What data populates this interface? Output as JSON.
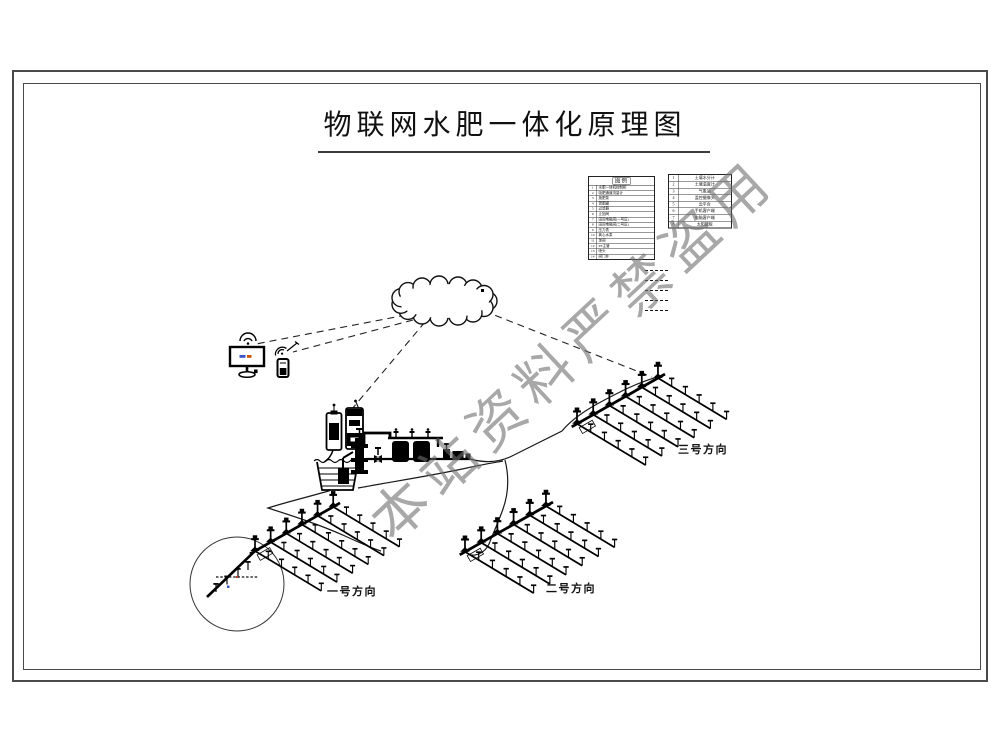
{
  "page": {
    "title": "物联网水肥一体化原理图"
  },
  "watermark": {
    "text": "本站资料严禁盗用"
  },
  "cloud": {
    "label": "云服务器"
  },
  "legend": {
    "title": "图例",
    "main_rows": [
      {
        "no": "1",
        "name": "水肥一体机控制柜"
      },
      {
        "no": "2",
        "name": "吸肥通道流量计"
      },
      {
        "no": "3",
        "name": "施肥泵"
      },
      {
        "no": "4",
        "name": "混肥罐"
      },
      {
        "no": "5",
        "name": "过滤器"
      },
      {
        "no": "6",
        "name": "止回阀"
      },
      {
        "no": "7",
        "name": "田间电磁阀(一号区)"
      },
      {
        "no": "8",
        "name": "田间电磁阀(二号区)"
      },
      {
        "no": "9",
        "name": "压力表"
      },
      {
        "no": "10",
        "name": "离心水泵"
      },
      {
        "no": "11",
        "name": "球阀"
      },
      {
        "no": "12",
        "name": "PE主管"
      },
      {
        "no": "13",
        "name": "喷头"
      },
      {
        "no": "14",
        "name": "阀门井"
      }
    ],
    "side_rows": [
      {
        "no": "1",
        "name": "土壤水分计"
      },
      {
        "no": "2",
        "name": "土壤温度计"
      },
      {
        "no": "3",
        "name": "气象站"
      },
      {
        "no": "4",
        "name": "监控摄像头"
      },
      {
        "no": "5",
        "name": "云平台"
      },
      {
        "no": "6",
        "name": "手机客户端"
      },
      {
        "no": "7",
        "name": "电脑客户端"
      },
      {
        "no": "8",
        "name": "太阳能板"
      }
    ],
    "line_samples": [
      {
        "label": ""
      },
      {
        "label": ""
      },
      {
        "label": ""
      },
      {
        "label": ""
      },
      {
        "label": ""
      }
    ]
  },
  "fields": [
    {
      "label": "一号方向"
    },
    {
      "label": "二号方向"
    },
    {
      "label": "三号方向"
    }
  ],
  "icons": [
    "wifi-icon",
    "monitor-icon",
    "phone-icon",
    "cloud-server-shape",
    "fertilizer-tank",
    "water-basin",
    "pump-filter-station",
    "sprinkler-grid",
    "detail-circle"
  ]
}
